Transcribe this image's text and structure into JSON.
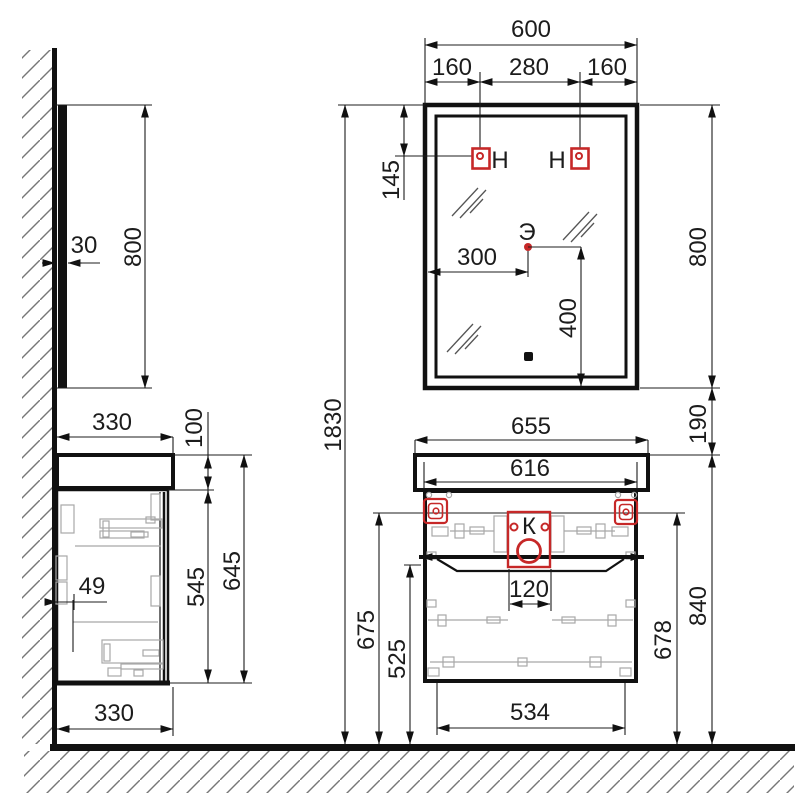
{
  "labels": {
    "socket": "Э",
    "drain": "К",
    "bracket_left": "H",
    "bracket_right": "H"
  },
  "dims": {
    "mirror_width": "600",
    "mirror_left": "160",
    "mirror_center": "280",
    "mirror_right": "160",
    "mirror_thickness": "30",
    "mirror_height": "800",
    "bracket_drop": "145",
    "socket_x": "300",
    "socket_y": "400",
    "mirror_height_right": "800",
    "gap_mirror_cabinet": "190",
    "total_height": "1830",
    "counter_depth": "330",
    "counter_rise": "100",
    "cabinet_side_height": "545",
    "cabinet_side_total": "645",
    "wall_gap": "49",
    "counter_depth_bottom": "330",
    "counter_width": "655",
    "cabinet_width": "616",
    "counter_height_floor": "840",
    "bracket_height_right": "678",
    "bracket_height_left": "675",
    "basin_height": "525",
    "drain_width": "120",
    "cabinet_bottom_width": "534"
  },
  "colors": {
    "accent_red": "#c62828",
    "line": "#111111",
    "hardware_gray": "#a8a8a8"
  }
}
